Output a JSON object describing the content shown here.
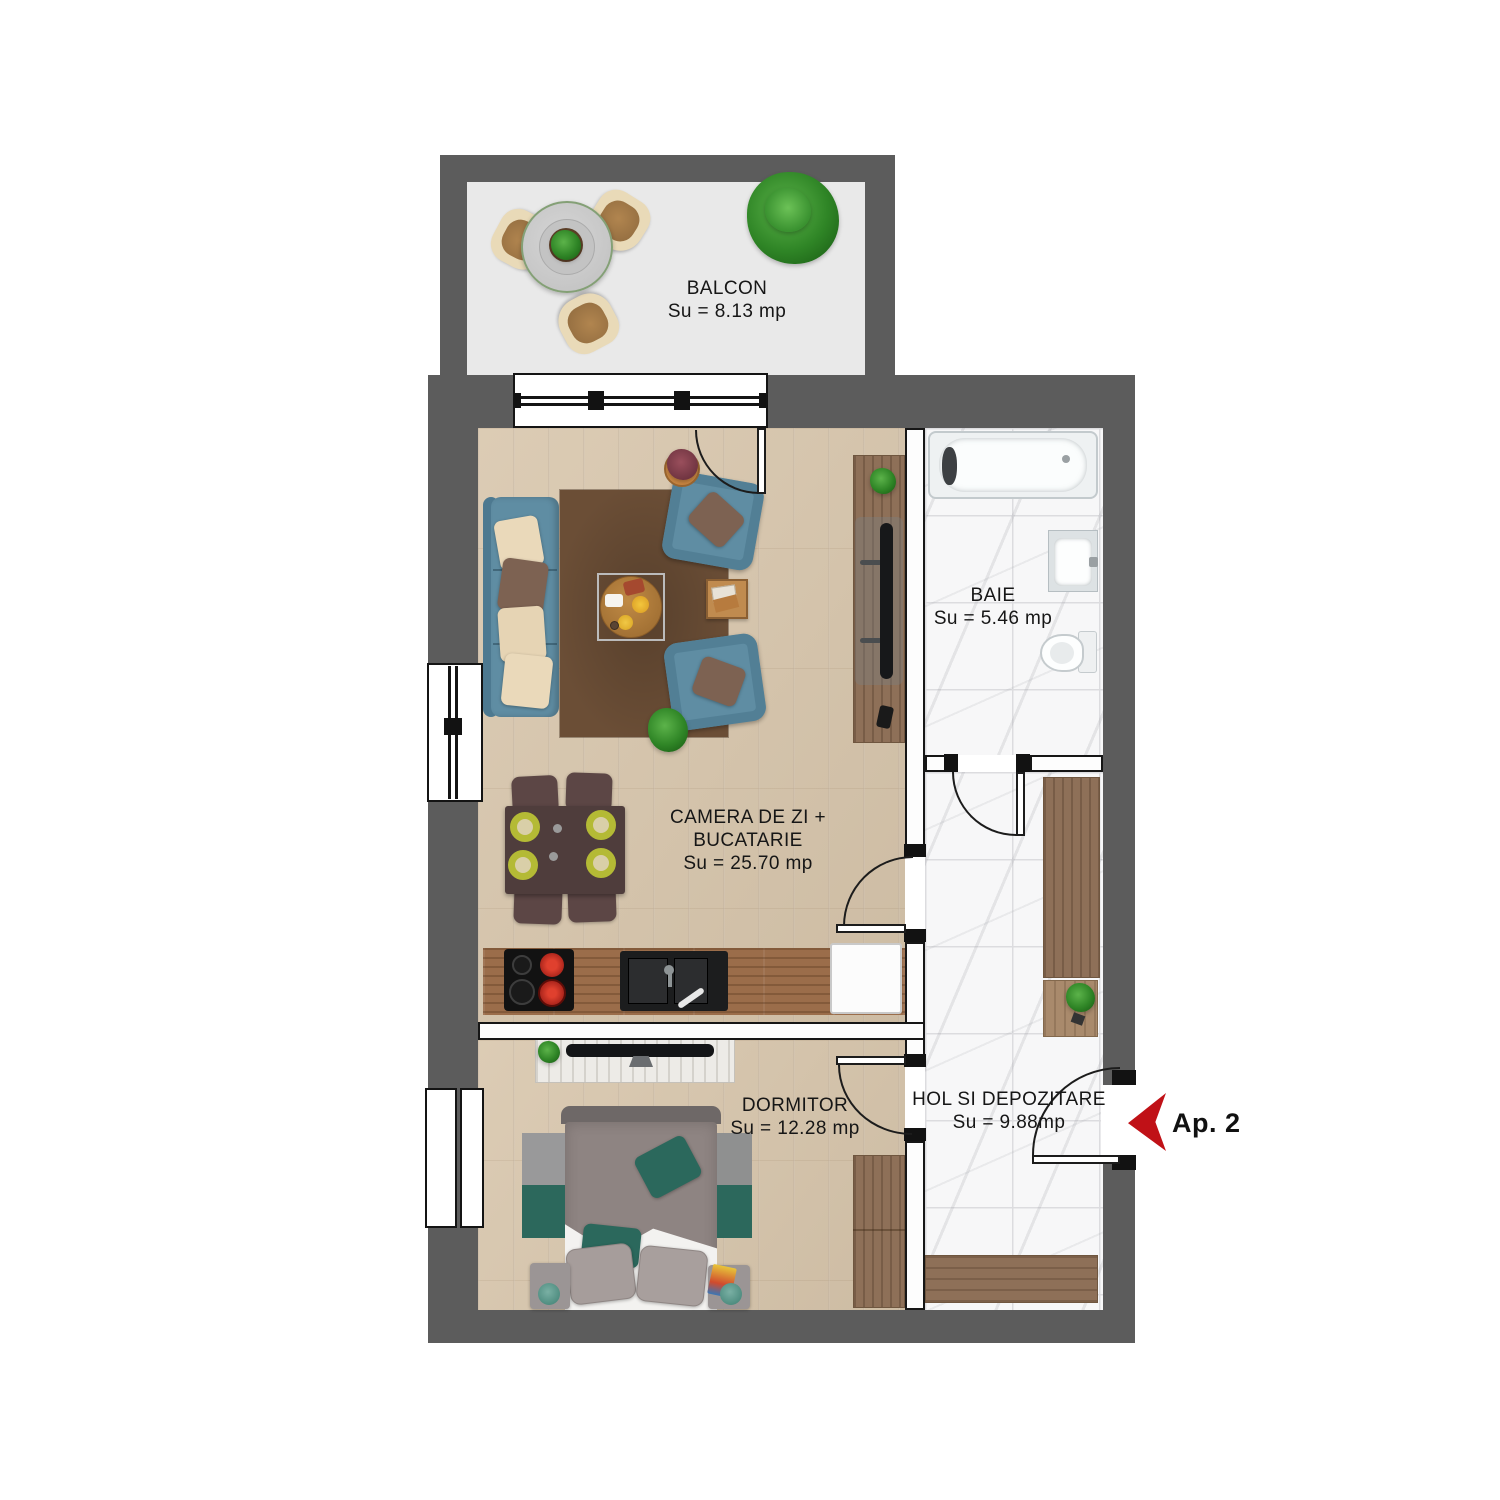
{
  "floor_plan": {
    "apartment": {
      "label": "Ap. 2"
    },
    "rooms": {
      "balcon": {
        "name": "BALCON",
        "area": "Su = 8.13 mp"
      },
      "living": {
        "name_line1": "CAMERA DE ZI +",
        "name_line2": "BUCATARIE",
        "area": "Su = 25.70 mp"
      },
      "baie": {
        "name": "BAIE",
        "area": "Su = 5.46 mp"
      },
      "dormitor": {
        "name": "DORMITOR",
        "area": "Su = 12.28 mp"
      },
      "hol": {
        "name": "HOL SI DEPOZITARE",
        "area": "Su = 9.88mp"
      }
    },
    "colors": {
      "wall": "#5c5c5c",
      "balcony_floor": "#e9e9e9",
      "wood_floor": "#d8c6ac",
      "marble_floor": "#f7f7f8",
      "kitchen_counter": "#9b6d4a",
      "cabinet_wood": "#8e7058",
      "sofa_blue": "#5f8da3",
      "rug_brown": "#6b4e36",
      "bed_gray": "#8e8482",
      "accent_teal": "#2b685c",
      "entrance_arrow_red": "#c01117"
    }
  }
}
